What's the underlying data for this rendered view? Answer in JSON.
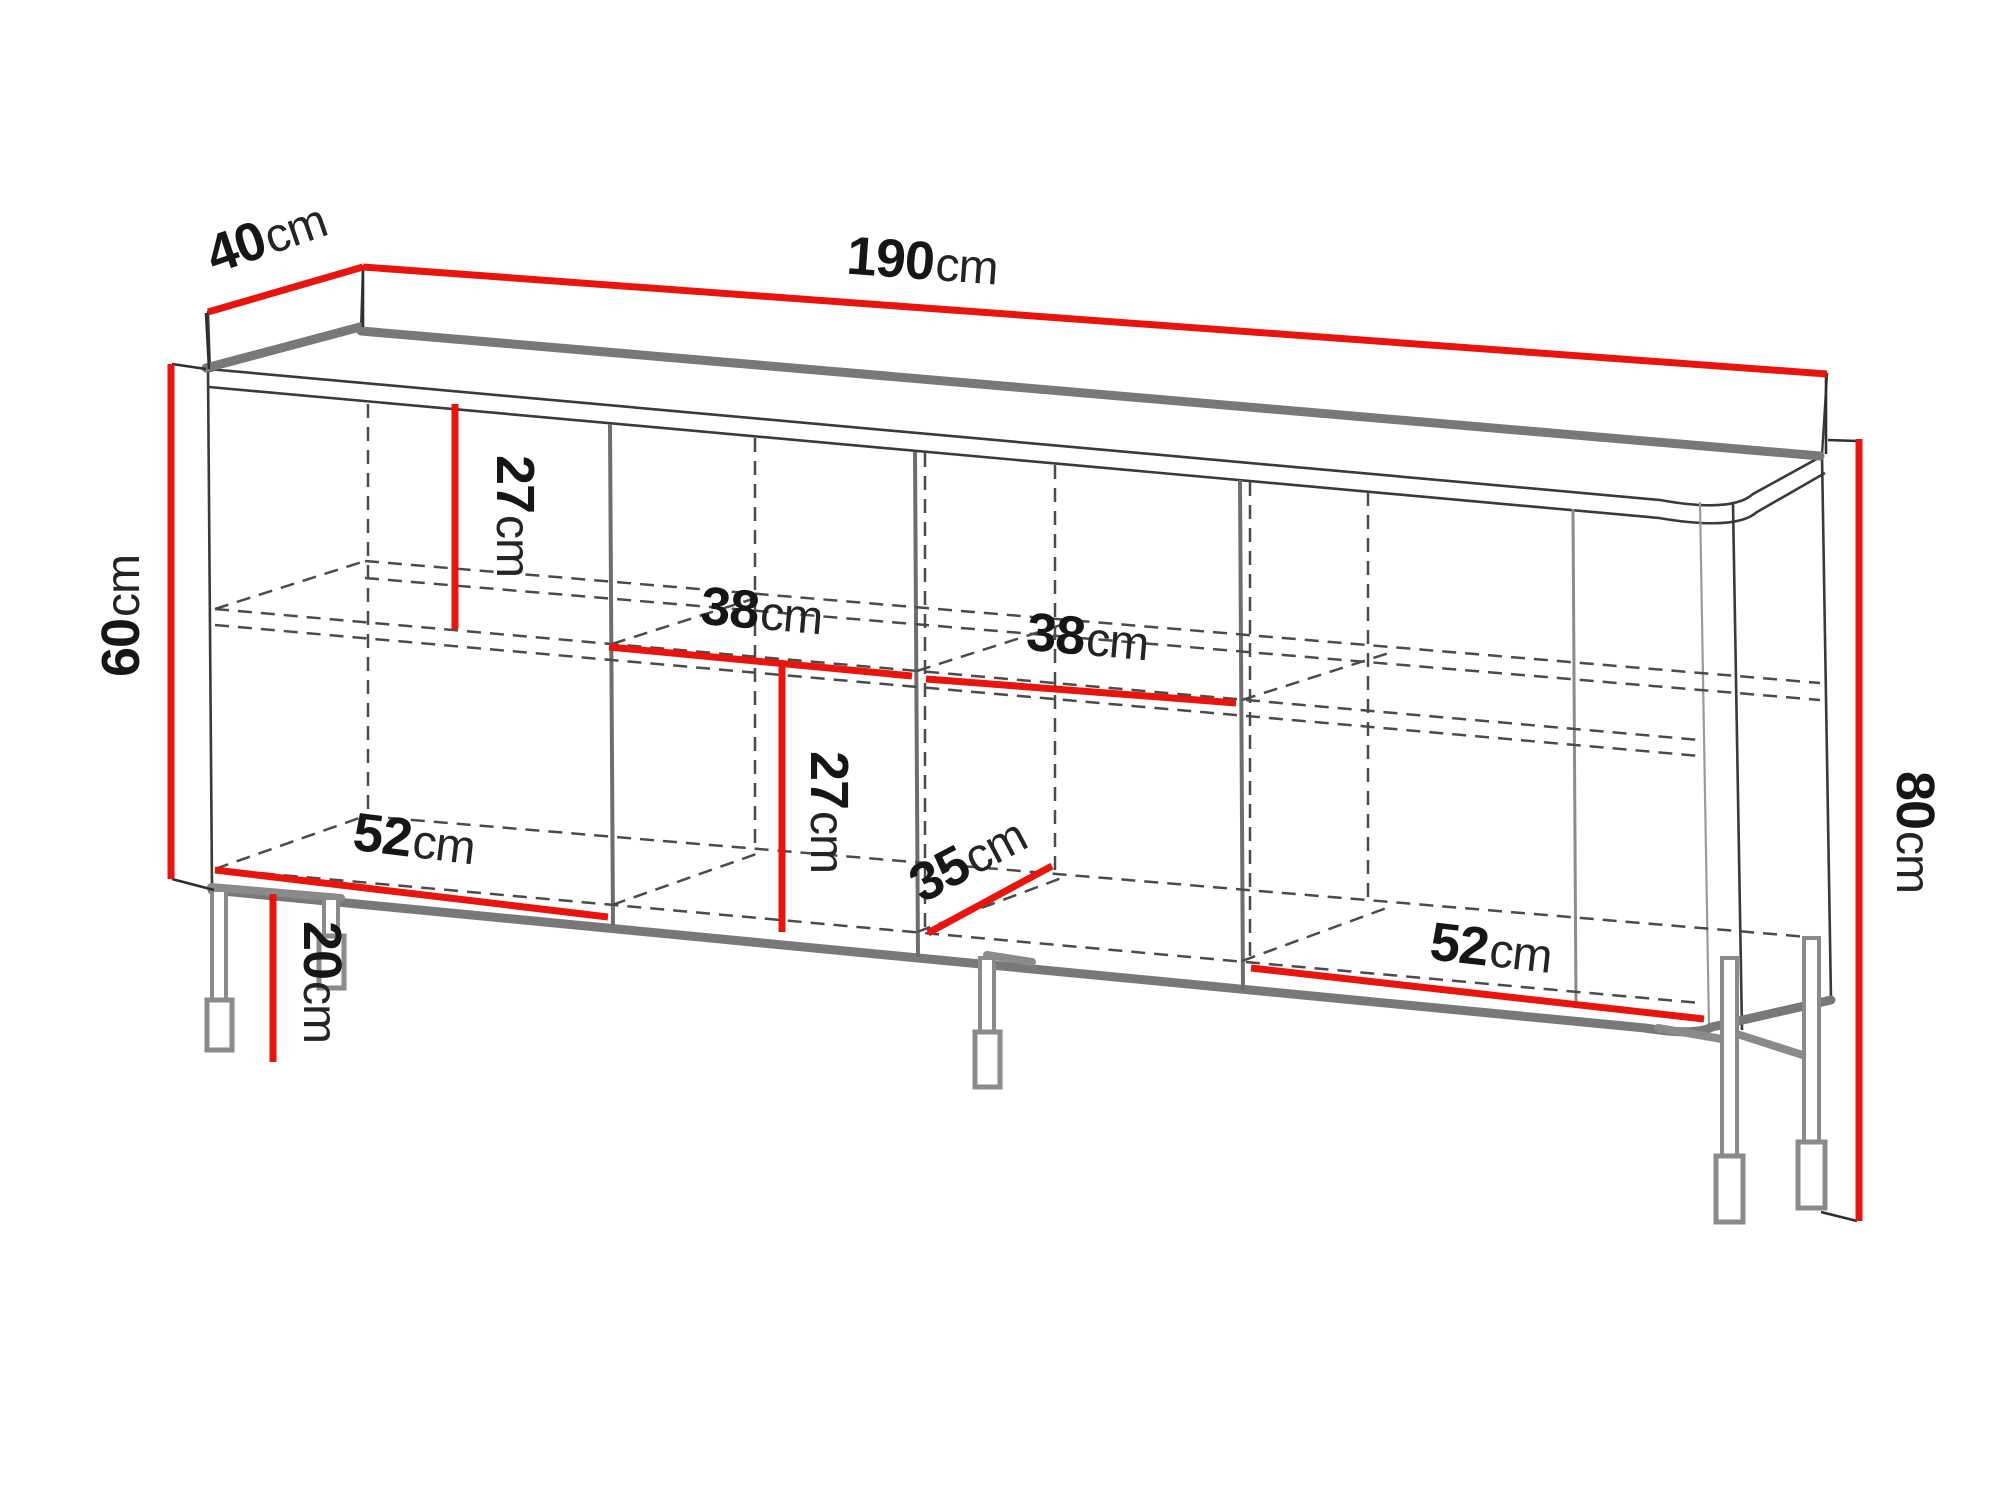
{
  "diagram": {
    "name": "sideboard-dimension-diagram",
    "type": "furniture technical drawing",
    "unit": "cm",
    "colors": {
      "dimension_accent": "#e8150f",
      "cabinet_edge_gray": "#787878",
      "hidden_line_gray": "#4b4b4b",
      "label_text": "#161616",
      "background": "#ffffff"
    },
    "dims": [
      {
        "id": "top-depth",
        "value": "40",
        "unit": "cm"
      },
      {
        "id": "top-width",
        "value": "190",
        "unit": "cm"
      },
      {
        "id": "carcass-height-left",
        "value": "60",
        "unit": "cm"
      },
      {
        "id": "upper-compartment-height",
        "value": "27",
        "unit": "cm"
      },
      {
        "id": "shelf-width-left",
        "value": "38",
        "unit": "cm"
      },
      {
        "id": "shelf-width-right",
        "value": "38",
        "unit": "cm"
      },
      {
        "id": "lower-compartment-height",
        "value": "27",
        "unit": "cm"
      },
      {
        "id": "interior-depth-left",
        "value": "52",
        "unit": "cm"
      },
      {
        "id": "leg-height",
        "value": "20",
        "unit": "cm"
      },
      {
        "id": "interior-depth-middle",
        "value": "35",
        "unit": "cm"
      },
      {
        "id": "interior-depth-right",
        "value": "52",
        "unit": "cm"
      },
      {
        "id": "total-height-right",
        "value": "80",
        "unit": "cm"
      }
    ]
  }
}
